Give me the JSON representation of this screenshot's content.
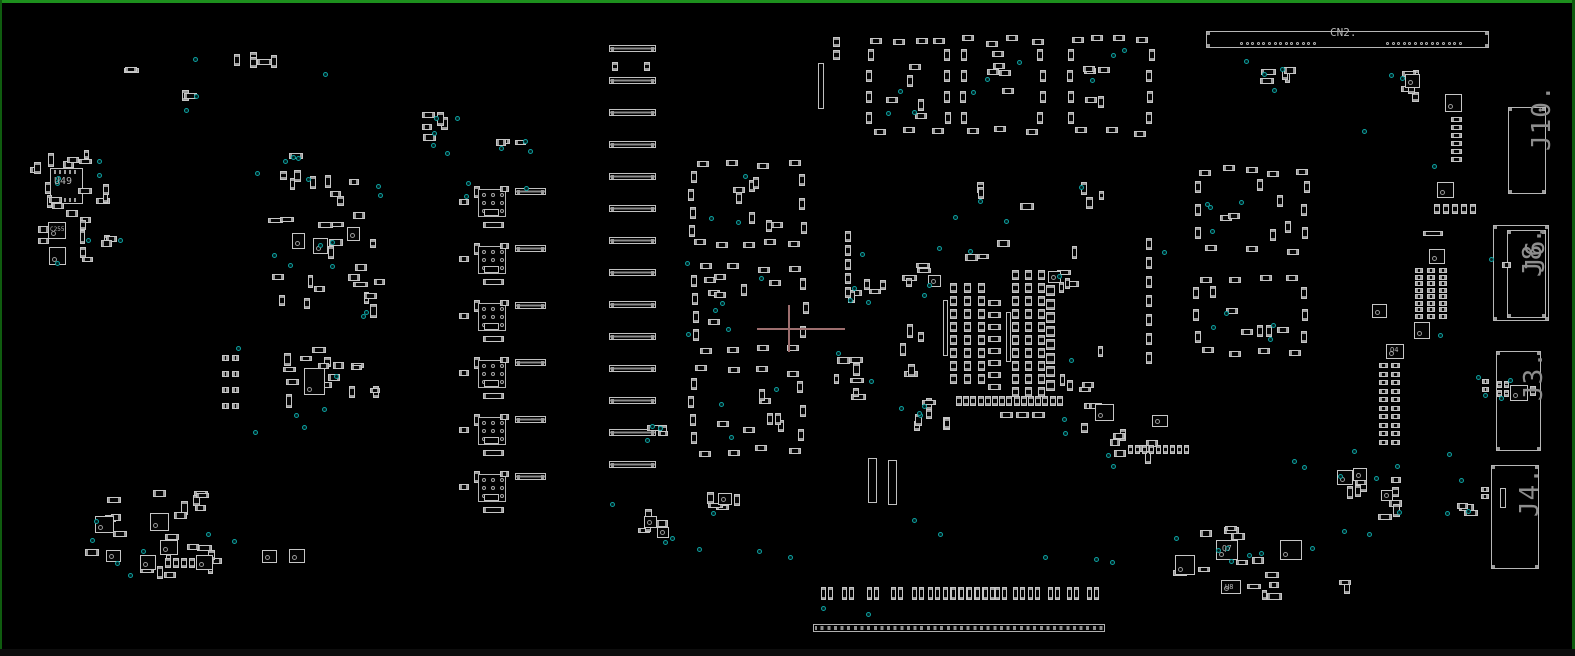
{
  "canvas": {
    "w": 1575,
    "h": 656
  },
  "colors": {
    "background": "#000000",
    "border_top": "#1d8f1d",
    "border_side": "#0f5c0f",
    "component_outline": "#c6c6c6",
    "pad": "#9b9b9b",
    "connector_outline": "#b6b6b6",
    "test_point": "#0da0a0",
    "ref_label": "#b6b6b6",
    "big_label": "#8d8d8d",
    "cursor": "#9d6e6e"
  },
  "labels": {
    "cn2": {
      "text": "CN2."
    },
    "u49": {
      "text": "U49"
    },
    "c255": {
      "text": "C255"
    },
    "q4": {
      "text": "Q4"
    },
    "q7": {
      "text": "Q7"
    },
    "u8": {
      "text": "U8"
    },
    "j10": {
      "text": "J10."
    },
    "j8": {
      "text": "J8."
    },
    "j6": {
      "text": "J6."
    },
    "j3": {
      "text": "J3."
    },
    "j4": {
      "text": "J4."
    }
  },
  "cn2_connector": {
    "x": 1206,
    "y": 31,
    "w": 283,
    "h": 17,
    "dot_y": 42,
    "dot_runs": [
      {
        "x": 1240,
        "n": 14,
        "step": 5.6
      },
      {
        "x": 1386,
        "n": 14,
        "step": 5.6
      }
    ]
  },
  "right_connectors": [
    {
      "id": "j10",
      "x": 1508,
      "y": 107,
      "w": 38,
      "h": 87
    },
    {
      "id": "j6",
      "x": 1493,
      "y": 225,
      "w": 56,
      "h": 96,
      "inner": {
        "x": 1507,
        "y": 230,
        "w": 39,
        "h": 88
      },
      "overlay": "j8"
    },
    {
      "id": "j3",
      "x": 1496,
      "y": 351,
      "w": 45,
      "h": 100
    },
    {
      "id": "j4",
      "x": 1491,
      "y": 465,
      "w": 48,
      "h": 104
    }
  ],
  "u49_ic": {
    "x": 50,
    "y": 168,
    "w": 33,
    "h": 36
  },
  "bar_stack": {
    "x": 609,
    "w": 47,
    "h": 7,
    "y0": 45,
    "step": 32,
    "count": 14
  },
  "relay_units": {
    "x": 470,
    "y0": 185,
    "step": 57,
    "count": 6
  },
  "edge_connector": {
    "x": 813,
    "y": 624,
    "w": 292,
    "h": 8
  },
  "bottom_pairs": {
    "y": 587,
    "xs": [
      821,
      842,
      867,
      891,
      912,
      928,
      943,
      951,
      959,
      967,
      975,
      983,
      995,
      1013,
      1028,
      1048,
      1067,
      1087
    ]
  },
  "rings": [
    {
      "x": 865,
      "y": 35,
      "w": 88,
      "h": 103,
      "nt": 4,
      "nb": 3,
      "nl": 4,
      "nr": 4,
      "ni": 5,
      "nd": 3,
      "seed": 11
    },
    {
      "x": 958,
      "y": 35,
      "w": 90,
      "h": 103,
      "nt": 4,
      "nb": 3,
      "nl": 4,
      "nr": 4,
      "ni": 5,
      "nd": 3,
      "seed": 12
    },
    {
      "x": 1066,
      "y": 35,
      "w": 90,
      "h": 103,
      "nt": 4,
      "nb": 3,
      "nl": 4,
      "nr": 4,
      "ni": 5,
      "nd": 3,
      "seed": 13
    },
    {
      "x": 688,
      "y": 158,
      "w": 120,
      "h": 92,
      "nt": 4,
      "nb": 5,
      "nl": 4,
      "nr": 3,
      "ni": 7,
      "nd": 3,
      "seed": 21
    },
    {
      "x": 690,
      "y": 262,
      "w": 120,
      "h": 92,
      "nt": 4,
      "nb": 4,
      "nl": 4,
      "nr": 3,
      "ni": 7,
      "nd": 4,
      "seed": 22
    },
    {
      "x": 688,
      "y": 365,
      "w": 120,
      "h": 92,
      "nt": 4,
      "nb": 4,
      "nl": 4,
      "nr": 3,
      "ni": 7,
      "nd": 3,
      "seed": 23
    },
    {
      "x": 1192,
      "y": 165,
      "w": 120,
      "h": 90,
      "nt": 5,
      "nb": 3,
      "nl": 3,
      "nr": 3,
      "ni": 6,
      "nd": 4,
      "seed": 31
    },
    {
      "x": 1192,
      "y": 272,
      "w": 118,
      "h": 86,
      "nt": 4,
      "nb": 4,
      "nl": 3,
      "nr": 3,
      "ni": 6,
      "nd": 4,
      "seed": 32
    }
  ],
  "scatter": [
    [
      28,
      145,
      92,
      118,
      26,
      6,
      101
    ],
    [
      230,
      52,
      48,
      16,
      5,
      0,
      102
    ],
    [
      116,
      66,
      24,
      12,
      2,
      0,
      103
    ],
    [
      270,
      150,
      112,
      58,
      9,
      4,
      104
    ],
    [
      268,
      212,
      118,
      108,
      20,
      5,
      105
    ],
    [
      282,
      345,
      100,
      80,
      16,
      3,
      106
    ],
    [
      85,
      485,
      148,
      96,
      22,
      7,
      107
    ],
    [
      636,
      508,
      36,
      30,
      4,
      1,
      108
    ],
    [
      700,
      487,
      52,
      28,
      5,
      1,
      109
    ],
    [
      826,
      345,
      44,
      55,
      7,
      2,
      110
    ],
    [
      1058,
      338,
      55,
      95,
      9,
      3,
      111
    ],
    [
      1098,
      425,
      75,
      40,
      7,
      2,
      112
    ],
    [
      1335,
      458,
      80,
      62,
      9,
      4,
      113
    ],
    [
      1165,
      523,
      118,
      78,
      13,
      6,
      114
    ],
    [
      1253,
      48,
      45,
      42,
      5,
      2,
      115
    ],
    [
      1388,
      62,
      40,
      42,
      5,
      2,
      116
    ],
    [
      418,
      108,
      42,
      48,
      5,
      3,
      117
    ],
    [
      488,
      138,
      42,
      20,
      3,
      2,
      118
    ],
    [
      845,
      268,
      42,
      42,
      5,
      2,
      119
    ],
    [
      1455,
      502,
      28,
      14,
      3,
      0,
      121
    ],
    [
      1336,
      580,
      22,
      12,
      2,
      0,
      122
    ],
    [
      180,
      88,
      18,
      14,
      2,
      1,
      125
    ],
    [
      900,
      262,
      40,
      38,
      5,
      1,
      130
    ],
    [
      1055,
      262,
      40,
      36,
      4,
      1,
      131
    ],
    [
      898,
      398,
      60,
      35,
      7,
      2,
      133
    ],
    [
      880,
      182,
      250,
      28,
      6,
      2,
      134
    ],
    [
      940,
      240,
      140,
      25,
      4,
      1,
      135
    ],
    [
      900,
      300,
      24,
      80,
      5,
      0,
      136
    ],
    [
      645,
      418,
      30,
      25,
      3,
      2,
      124
    ]
  ],
  "grids": [
    [
      1415,
      268,
      3,
      8,
      12,
      6.5,
      8,
      5,
      "chip-h"
    ],
    [
      1379,
      363,
      2,
      10,
      12,
      8.5,
      9,
      5,
      "chip-h"
    ],
    [
      1451,
      117,
      1,
      6,
      0,
      8,
      11,
      5,
      "chip-h"
    ],
    [
      1434,
      204,
      5,
      1,
      9,
      0,
      6,
      10,
      "chip-v"
    ],
    [
      950,
      283,
      3,
      8,
      14,
      13,
      7,
      10,
      "chip-v"
    ],
    [
      988,
      300,
      1,
      8,
      0,
      12,
      13,
      6,
      "chip-h"
    ],
    [
      1012,
      270,
      3,
      10,
      13,
      13,
      7,
      10,
      "chip-v"
    ],
    [
      1046,
      285,
      1,
      8,
      0,
      13.5,
      9,
      11,
      "chip-v"
    ],
    [
      956,
      396,
      15,
      1,
      7.2,
      0,
      6,
      10,
      "chip-v"
    ],
    [
      1000,
      412,
      3,
      1,
      16,
      0,
      13,
      6,
      "chip-h"
    ],
    [
      1128,
      445,
      9,
      1,
      7,
      0,
      5,
      9,
      "chip-v"
    ],
    [
      1146,
      238,
      1,
      7,
      0,
      19,
      6,
      12,
      "chip-v"
    ],
    [
      845,
      231,
      1,
      5,
      0,
      14,
      6,
      11,
      "chip-v"
    ],
    [
      222,
      355,
      2,
      4,
      10,
      16,
      7,
      6,
      "chip-h"
    ],
    [
      165,
      558,
      4,
      1,
      8,
      0,
      6,
      10,
      "chip-v"
    ]
  ],
  "squares": [
    [
      48,
      222,
      18,
      17
    ],
    [
      49,
      247,
      17,
      18
    ],
    [
      292,
      233,
      13,
      16
    ],
    [
      313,
      238,
      15,
      16
    ],
    [
      347,
      227,
      13,
      14
    ],
    [
      304,
      368,
      21,
      27
    ],
    [
      95,
      516,
      19,
      17
    ],
    [
      150,
      513,
      19,
      18
    ],
    [
      160,
      540,
      18,
      15
    ],
    [
      140,
      555,
      16,
      15
    ],
    [
      196,
      555,
      17,
      15
    ],
    [
      106,
      550,
      15,
      12
    ],
    [
      262,
      550,
      15,
      13
    ],
    [
      289,
      549,
      16,
      14
    ],
    [
      1216,
      540,
      22,
      20
    ],
    [
      1280,
      540,
      22,
      20
    ],
    [
      1175,
      555,
      20,
      20
    ],
    [
      1221,
      580,
      20,
      14
    ],
    [
      1337,
      470,
      16,
      15
    ],
    [
      1353,
      468,
      14,
      13
    ],
    [
      1381,
      490,
      12,
      11
    ],
    [
      1405,
      74,
      15,
      14
    ],
    [
      1445,
      94,
      17,
      18
    ],
    [
      1437,
      182,
      17,
      16
    ],
    [
      1429,
      249,
      16,
      15
    ],
    [
      1372,
      304,
      15,
      14
    ],
    [
      1414,
      322,
      16,
      17
    ],
    [
      1386,
      344,
      18,
      15
    ],
    [
      1095,
      404,
      19,
      17
    ],
    [
      1152,
      415,
      16,
      12
    ],
    [
      928,
      275,
      13,
      12
    ],
    [
      1048,
      271,
      13,
      12
    ],
    [
      644,
      516,
      13,
      12
    ],
    [
      657,
      527,
      12,
      11
    ],
    [
      718,
      493,
      14,
      12
    ]
  ],
  "rects": [
    [
      1502,
      262,
      9,
      6,
      "chip-h"
    ],
    [
      1510,
      385,
      18,
      16,
      "sqic"
    ],
    [
      1497,
      381,
      5,
      7,
      "chip-v"
    ],
    [
      1504,
      381,
      5,
      7,
      "chip-v"
    ],
    [
      1497,
      390,
      5,
      7,
      "chip-v"
    ],
    [
      1504,
      390,
      5,
      7,
      "chip-v"
    ],
    [
      1530,
      386,
      6,
      10,
      "chip-v"
    ],
    [
      1482,
      379,
      7,
      5,
      "chip-h"
    ],
    [
      1482,
      387,
      7,
      5,
      "chip-h"
    ],
    [
      1500,
      488,
      6,
      20,
      "tallv"
    ],
    [
      1481,
      487,
      8,
      5,
      "chip-h"
    ],
    [
      1481,
      494,
      8,
      5,
      "chip-h"
    ],
    [
      612,
      62,
      6,
      9,
      "chip-v"
    ],
    [
      644,
      62,
      6,
      9,
      "chip-v"
    ],
    [
      818,
      63,
      6,
      46,
      "tallv"
    ],
    [
      833,
      37,
      7,
      10,
      "chip-v"
    ],
    [
      833,
      50,
      7,
      10,
      "chip-v"
    ],
    [
      868,
      458,
      9,
      45,
      "tallv"
    ],
    [
      888,
      460,
      9,
      45,
      "tallv"
    ],
    [
      1423,
      231,
      20,
      5,
      "chip-h"
    ],
    [
      943,
      300,
      5,
      56,
      "tallv"
    ],
    [
      1006,
      312,
      5,
      50,
      "tallv"
    ]
  ],
  "dots": [
    [
      193,
      57
    ],
    [
      323,
      72
    ],
    [
      434,
      116
    ],
    [
      431,
      143
    ],
    [
      499,
      146
    ],
    [
      97,
      159
    ],
    [
      184,
      108
    ],
    [
      255,
      171
    ],
    [
      291,
      155
    ],
    [
      306,
      177
    ],
    [
      330,
      240
    ],
    [
      330,
      264
    ],
    [
      236,
      346
    ],
    [
      302,
      425
    ],
    [
      253,
      430
    ],
    [
      524,
      186
    ],
    [
      466,
      181
    ],
    [
      464,
      194
    ],
    [
      685,
      261
    ],
    [
      663,
      540
    ],
    [
      697,
      547
    ],
    [
      650,
      424
    ],
    [
      852,
      286
    ],
    [
      922,
      293
    ],
    [
      899,
      406
    ],
    [
      917,
      411
    ],
    [
      1004,
      219
    ],
    [
      953,
      215
    ],
    [
      860,
      252
    ],
    [
      937,
      246
    ],
    [
      1162,
      250
    ],
    [
      1292,
      459
    ],
    [
      1302,
      465
    ],
    [
      1342,
      529
    ],
    [
      1367,
      532
    ],
    [
      1438,
      333
    ],
    [
      1447,
      452
    ],
    [
      1352,
      449
    ],
    [
      1310,
      546
    ],
    [
      1459,
      478
    ],
    [
      1489,
      257
    ],
    [
      1476,
      375
    ],
    [
      1483,
      393
    ],
    [
      1508,
      378
    ],
    [
      1499,
      396
    ],
    [
      1445,
      511
    ],
    [
      1244,
      59
    ],
    [
      1272,
      88
    ],
    [
      1432,
      164
    ],
    [
      1362,
      129
    ],
    [
      912,
      518
    ],
    [
      938,
      532
    ],
    [
      1043,
      555
    ],
    [
      1094,
      557
    ],
    [
      1110,
      560
    ],
    [
      821,
      606
    ],
    [
      866,
      612
    ],
    [
      1466,
      509
    ],
    [
      757,
      549
    ],
    [
      788,
      555
    ],
    [
      686,
      332
    ],
    [
      610,
      502
    ]
  ],
  "cursor": {
    "x": 789,
    "y": 329,
    "x1": 757,
    "x2": 845,
    "y1": 305,
    "y2": 352
  }
}
